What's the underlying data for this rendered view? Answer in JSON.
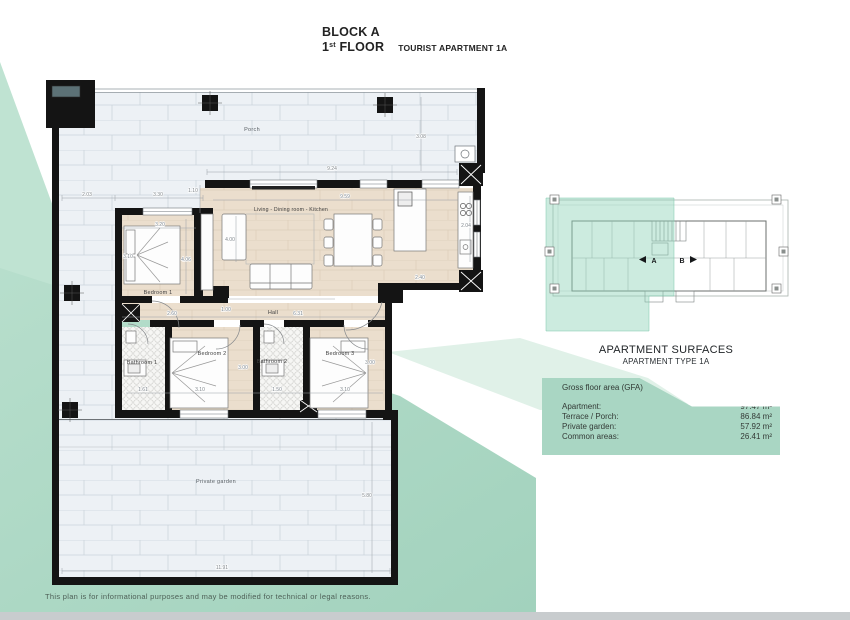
{
  "header": {
    "block": "BLOCK A",
    "floor_prefix": "1",
    "floor_sup": "st",
    "floor_label": " FLOOR",
    "apartment": "TOURIST APARTMENT 1A"
  },
  "plan": {
    "rooms": {
      "porch": "Porch",
      "living": "Living - Dining room - Kitchen",
      "bedroom1": "Bedroom 1",
      "hall": "Hall",
      "bathroom1": "Bathroom 1",
      "bedroom2": "Bedroom 2",
      "bathroom2": "Bathroom 2",
      "bedroom3": "Bedroom 3",
      "garden": "Private garden"
    },
    "dims": {
      "porch_left": "2.03",
      "porch_bed1": "3.30",
      "offset": "1.10",
      "porch_width": "9.24",
      "living_width": "9.59",
      "porch_depth": "3.08",
      "bed1_width": "3.20",
      "bed1_depth": "4.06",
      "bed1_bed": "3.10",
      "sofa": "4.00",
      "hall_door": "1.00",
      "hall_left": "2.60",
      "hall_right": "6.31",
      "bath1_w": "1.61",
      "bed2_w": "3.10",
      "bed2_d": "3.00",
      "bath2_w": "1.50",
      "bed3_w": "3.10",
      "bed3_d": "3.00",
      "kitchen_d": "2.04",
      "kitchen_w": "2.40",
      "garden_d": "5.80",
      "garden_w": "11.91"
    }
  },
  "key_plan": {
    "unit_a": "A",
    "unit_b": "B"
  },
  "surfaces": {
    "title": "APARTMENT SURFACES",
    "subtitle": "APARTMENT TYPE 1A",
    "header": "Gross floor area (GFA)",
    "rows": [
      {
        "label": "Apartment:",
        "value": "97.47 m²"
      },
      {
        "label": "Terrace / Porch:",
        "value": "86.84 m²"
      },
      {
        "label": "Private garden:",
        "value": "57.92 m²"
      },
      {
        "label": "Common areas:",
        "value": "26.41 m²"
      }
    ]
  },
  "disclaimer": "This plan is for informational purposes and may be modified for technical or legal reasons.",
  "colors": {
    "teal_panel": "#a9d6c3",
    "teal_wedge": "#bfe3d2",
    "teal_pale": "#e0f1e8",
    "wall": "#141414",
    "wood_floor": "#ebdecd",
    "tile": "#edf1f5",
    "bottom_strip": "#c8ccce"
  }
}
